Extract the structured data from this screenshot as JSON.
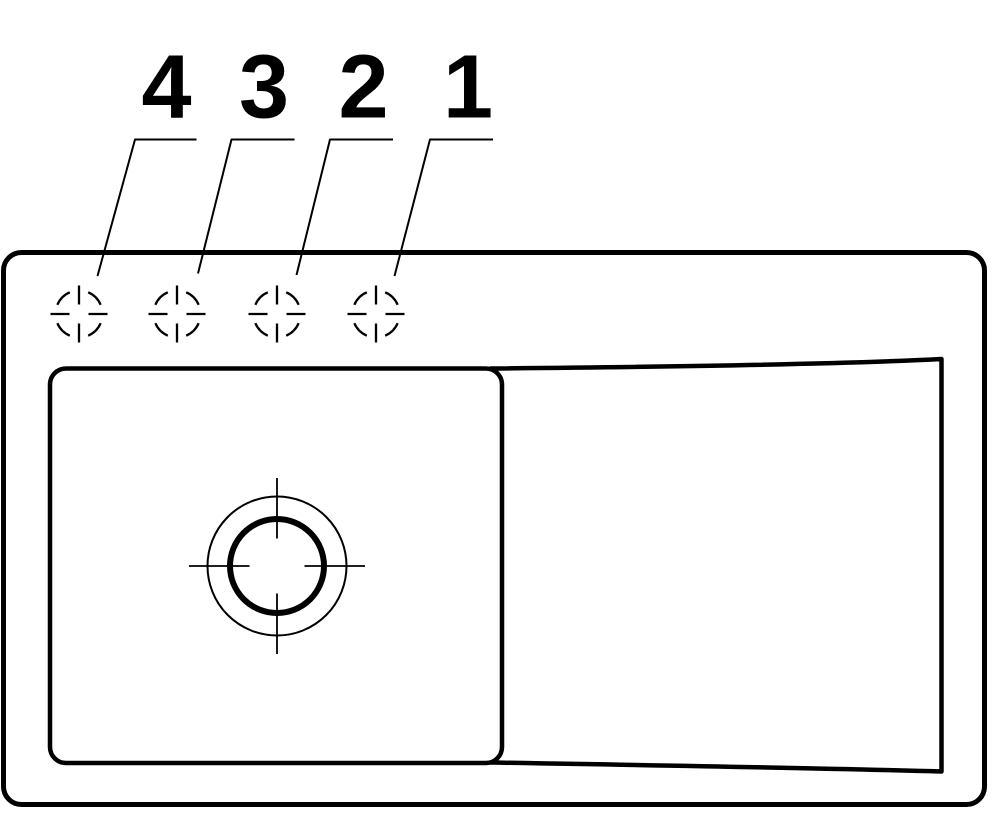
{
  "title": "Sink plan technical drawing",
  "colors": {
    "background": "#ffffff",
    "line": "#000000"
  },
  "canvas": {
    "width": 992,
    "height": 813
  },
  "labels": [
    {
      "text": "4",
      "x": 166.5,
      "y": 117.5
    },
    {
      "text": "3",
      "x": 264,
      "y": 117.5
    },
    {
      "text": "2",
      "x": 363.5,
      "y": 117.5
    },
    {
      "text": "1",
      "x": 468,
      "y": 117.5
    }
  ],
  "label_style": {
    "font_size": 90,
    "font_weight": "bold"
  },
  "leader_lines": [
    {
      "for_label": "4",
      "points": [
        [
          196.5,
          139.5
        ],
        [
          135,
          139.5
        ],
        [
          97.5,
          276
        ]
      ]
    },
    {
      "for_label": "3",
      "points": [
        [
          294.5,
          139.5
        ],
        [
          231.5,
          139.5
        ],
        [
          198,
          273.5
        ]
      ]
    },
    {
      "for_label": "2",
      "points": [
        [
          393,
          139.5
        ],
        [
          330,
          139.5
        ],
        [
          296.5,
          275
        ]
      ]
    },
    {
      "for_label": "1",
      "points": [
        [
          493,
          139.5
        ],
        [
          430,
          139.5
        ],
        [
          394.5,
          276
        ]
      ]
    }
  ],
  "leader_style": {
    "stroke_width": 2
  },
  "sink_outline": {
    "x": 3.5,
    "y": 252.5,
    "width": 981,
    "height": 552,
    "corner_radius": 18,
    "stroke_width": 5
  },
  "bowl": {
    "x": 50,
    "y": 368.5,
    "width": 452,
    "height": 394.5,
    "corner_radius": 16,
    "stroke_width": 4.5
  },
  "drainer": {
    "top": {
      "from": [
        490,
        368.5
      ],
      "control": [
        820,
        365.5
      ],
      "to": [
        941.5,
        359
      ]
    },
    "right": {
      "to": [
        941.5,
        771.5
      ]
    },
    "bottom": {
      "control": [
        820,
        768
      ],
      "to": [
        490,
        762.5
      ]
    },
    "stroke_width": 4.5
  },
  "tap_holes": {
    "centers": [
      {
        "label": "4",
        "cx": 79,
        "cy": 314
      },
      {
        "label": "3",
        "cx": 177,
        "cy": 314
      },
      {
        "label": "2",
        "cx": 277,
        "cy": 314
      },
      {
        "label": "1",
        "cx": 376,
        "cy": 314
      }
    ],
    "radius": 23.5,
    "gap_half_angle_deg": 23,
    "tick_inner": 9.5,
    "tick_outer": 28.5,
    "stroke_width": 2.3
  },
  "drain": {
    "cx": 277,
    "cy": 566,
    "outer_radius": 69.5,
    "outer_stroke": 2,
    "ring_radius": 47,
    "ring_stroke": 6,
    "cross_inner": 27.5,
    "cross_outer": 88,
    "cross_stroke": 1.8
  }
}
